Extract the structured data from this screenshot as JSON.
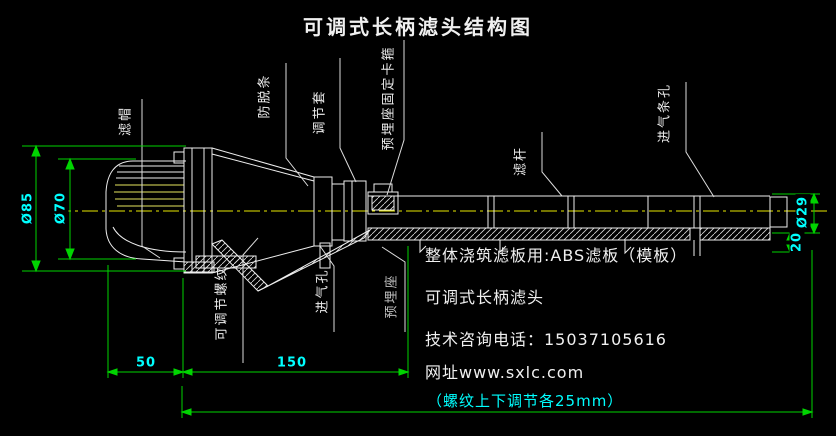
{
  "title": "可调式长柄滤头结构图",
  "colors": {
    "background": "#000000",
    "drawing_line": "#eeeeee",
    "centerline": "#e8e800",
    "dimension_line": "#00d400",
    "dimension_text": "#00ffff"
  },
  "part_labels": {
    "cap": "滤帽",
    "anti_detach_strip": "防脱条",
    "adjust_sleeve": "调节套",
    "seat_clamp": "预埋座固定卡箍",
    "rod": "滤杆",
    "air_slot": "进气条孔",
    "adjust_thread": "可调节螺纹",
    "air_hole": "进气孔",
    "embedded_seat": "预埋座"
  },
  "dimensions": {
    "dia_85": "Ø85",
    "dia_70": "Ø70",
    "dia_29": "Ø29",
    "len_20": "20",
    "len_50": "50",
    "len_150": "150",
    "thread_note": "（螺纹上下调节各25mm）"
  },
  "notes": {
    "line1": "整体浇筑滤板用:ABS滤板（模板）",
    "line2": "可调式长柄滤头",
    "line3": "技术咨询电话：15037105616",
    "line4": "网址www.sxlc.com"
  }
}
